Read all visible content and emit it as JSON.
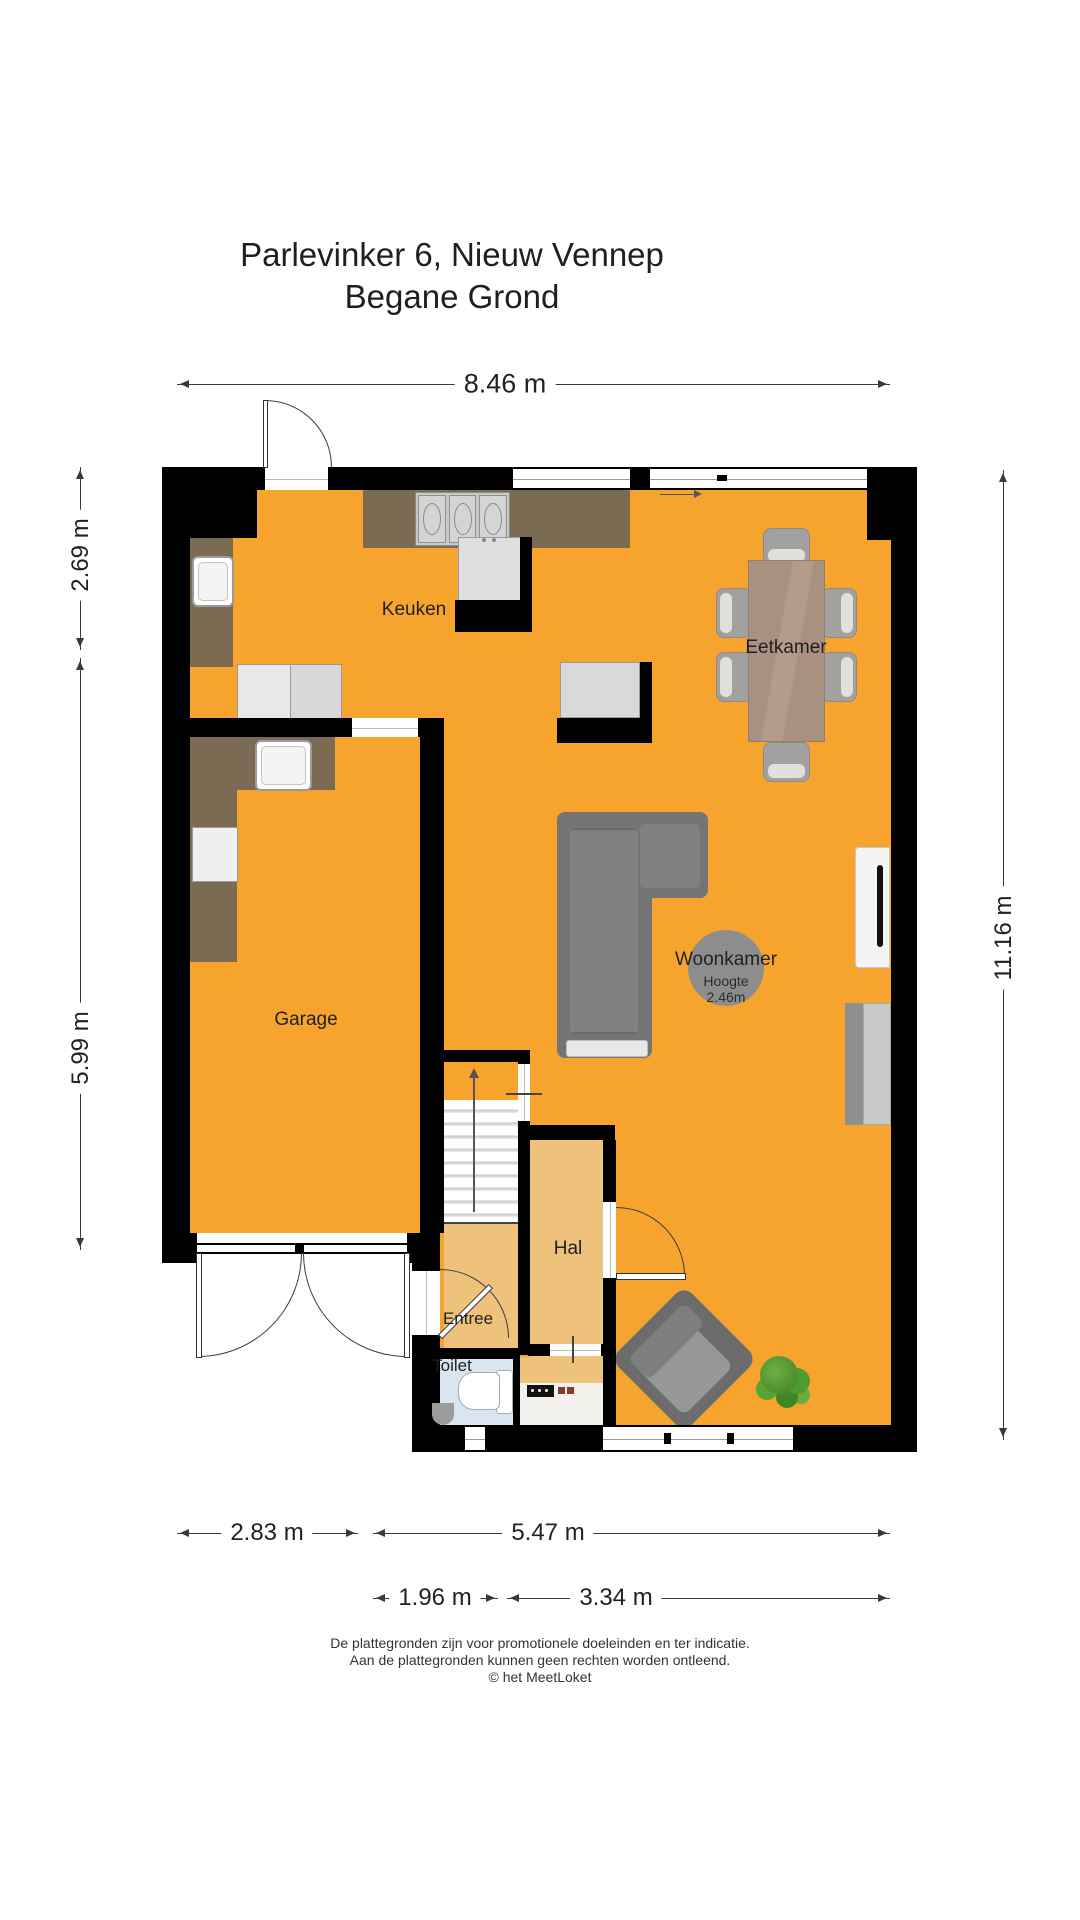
{
  "title": {
    "line1": "Parlevinker 6, Nieuw Vennep",
    "line2": "Begane Grond"
  },
  "rooms": {
    "keuken": "Keuken",
    "eetkamer": "Eetkamer",
    "woonkamer": "Woonkamer",
    "woonkamer_height_label": "Hoogte",
    "woonkamer_height_value": "2.46m",
    "garage": "Garage",
    "hal": "Hal",
    "entree": "Entree",
    "toilet": "Toilet"
  },
  "dimensions": {
    "top_width": "8.46 m",
    "left_kitchen_depth": "2.69 m",
    "left_garage_depth": "5.99 m",
    "right_total_depth": "11.16 m",
    "bottom_garage_width": "2.83 m",
    "bottom_living_width": "5.47 m",
    "bottom_hall_width": "1.96 m",
    "bottom_window_width": "3.34 m"
  },
  "footer": {
    "line1": "De plattegronden zijn voor promotionele doeleinden en ter indicatie.",
    "line2": "Aan de plattegronden kunnen geen rechten worden ontleend.",
    "line3": "© het MeetLoket"
  },
  "colors": {
    "floor_orange": "#F6A42D",
    "floor_pale": "#EFC27B",
    "toilet_blue": "#D9E5F0",
    "wall_black": "#000000",
    "counter_brown": "#7B6B52",
    "wood_table": "#A99080",
    "sofa_grey": "#747474",
    "circle_grey": "#8D8D8D",
    "plant_green": "#4E9B2F"
  }
}
